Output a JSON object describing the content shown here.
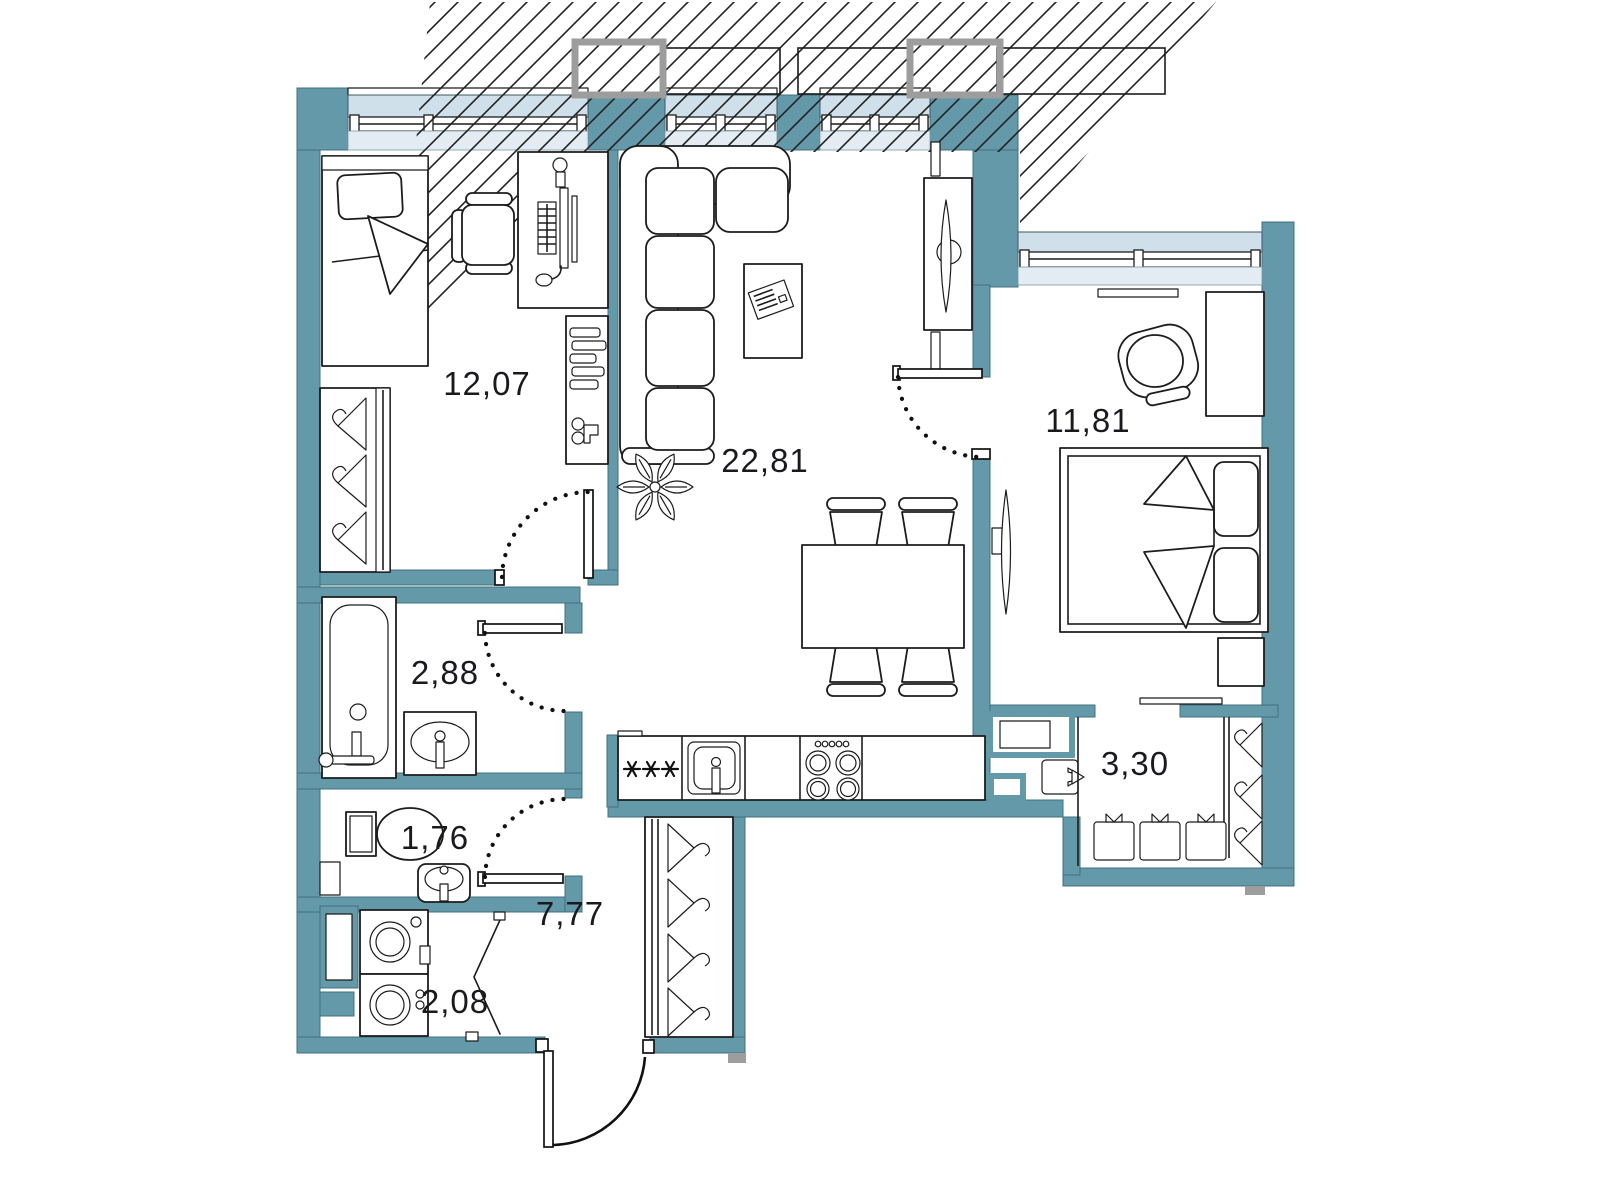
{
  "title": "Two-room apartment floor plan",
  "rooms": [
    {
      "id": "bedroom-1",
      "area": "12,07"
    },
    {
      "id": "living-kitchen",
      "area": "22,81"
    },
    {
      "id": "bedroom-2",
      "area": "11,81"
    },
    {
      "id": "bathroom",
      "area": "2,88"
    },
    {
      "id": "toilet",
      "area": "1,76"
    },
    {
      "id": "hallway",
      "area": "7,77"
    },
    {
      "id": "laundry",
      "area": "2,08"
    },
    {
      "id": "walk-in-closet",
      "area": "3,30"
    }
  ],
  "colors": {
    "wall": "#6499a9",
    "wall-edge": "#41707e",
    "glass": "#cfe0ea",
    "sill": "#e2ecf2",
    "line": "#1c1c1c",
    "gray": "#9d9d9d",
    "label": "#1a1a1e",
    "hatch": "#222222"
  },
  "icons": {
    "fridge": "snowflake-asterisk-icon",
    "wardrobes": "clothes-hanger-icon",
    "doors": "swing-arc-icon",
    "plant": "houseplant-icon"
  }
}
